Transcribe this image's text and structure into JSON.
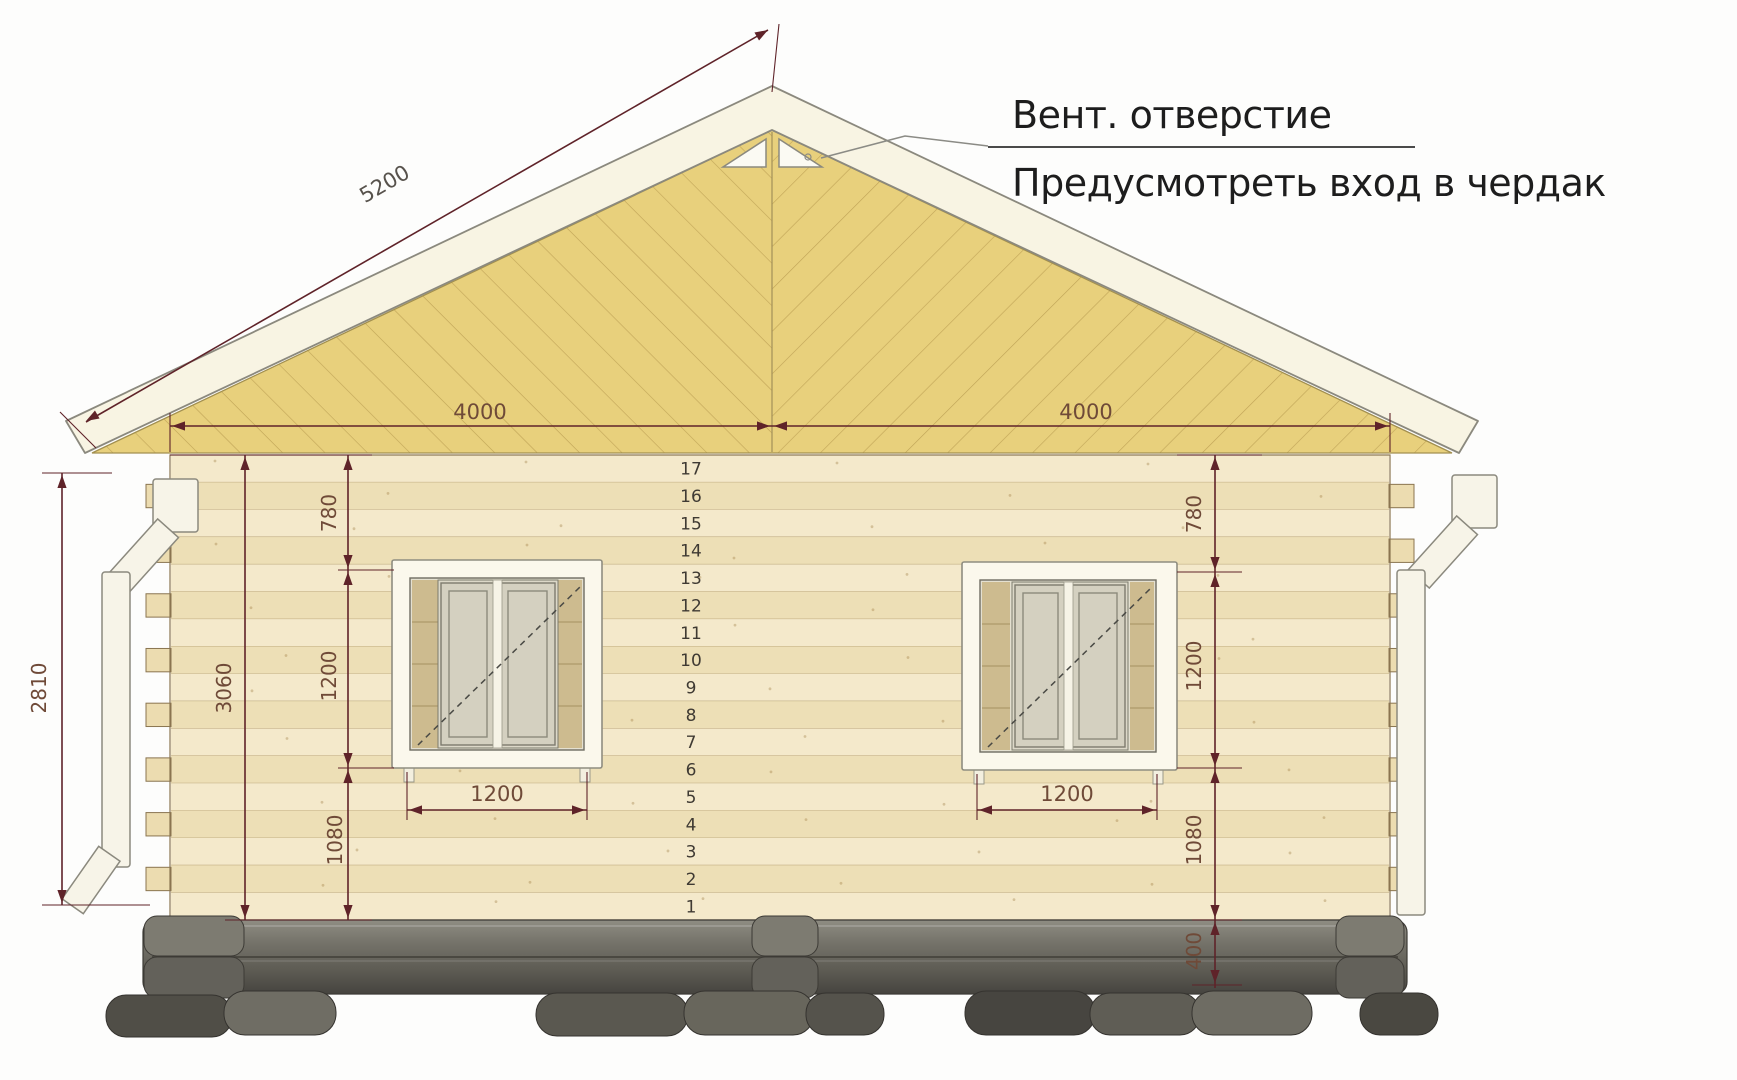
{
  "title": "House facade elevation drawing",
  "annotation": {
    "line1": "Вент. отверстие",
    "line2": "Предусмотреть вход в чердак"
  },
  "dimensions": {
    "roof_slope": "5200",
    "top_left_span": "4000",
    "top_right_span": "4000",
    "facade_height": "2810",
    "wall_height": "3060",
    "left_above_window": "780",
    "left_window_height": "1200",
    "left_below_window": "1080",
    "left_window_width": "1200",
    "right_above_window": "780",
    "right_window_height": "1200",
    "right_below_window": "1080",
    "foundation_height": "400",
    "right_window_width": "1200"
  },
  "log_rows": {
    "numbers": [
      "17",
      "16",
      "15",
      "14",
      "13",
      "12",
      "11",
      "10",
      "9",
      "8",
      "7",
      "6",
      "5",
      "4",
      "3",
      "2",
      "1"
    ]
  },
  "colors": {
    "dimension": "#5f2329",
    "dimension_text": "#6f4a38",
    "gable": "#e8d07c",
    "gable_line": "#b4954a",
    "wall_light": "#f4e9cb",
    "wall_dark": "#eddfb6",
    "wall_separator": "#bda87c",
    "notch_fill": "#ecdcb0",
    "notch_stroke": "#8a7550",
    "roof": "#f8f4e3",
    "foundation": "#6b695f",
    "annotation_text": "#1d1d1d"
  }
}
